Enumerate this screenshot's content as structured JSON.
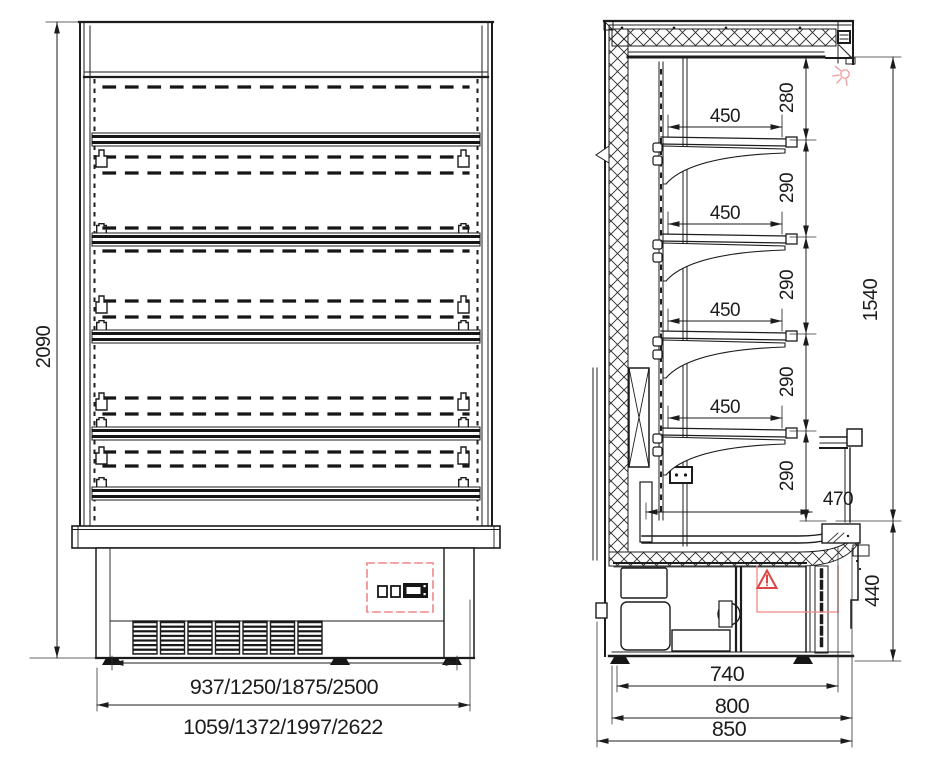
{
  "drawing": {
    "description": "Dimensioned technical drawing of a refrigerated multideck display cabinet: front elevation and side section",
    "front_view": {
      "dims": {
        "height": "2090",
        "inner_width": "937/1250/1875/2500",
        "overall_width": "1059/1372/1997/2622"
      }
    },
    "side_view": {
      "dims": {
        "top_clearance": "280",
        "shelf_pitch": [
          "290",
          "290",
          "290",
          "290"
        ],
        "shelf_depth": [
          "450",
          "450",
          "450",
          "450"
        ],
        "well_shelf_depth": "470",
        "opening_height": "1540",
        "base_height": "440",
        "base_depth": "740",
        "body_depth": "800",
        "overall_depth": "850"
      }
    },
    "icons": {
      "warning": "warning-triangle",
      "lamp": "light-indicator",
      "controller": "control-panel-display",
      "insulation": "cross-hatch",
      "grille": "ventilation-grille"
    },
    "colors": {
      "line": "#1c1c1c",
      "red_accent": "#dd4444",
      "soft_red": "#f08686",
      "pink": "#f2a2a2"
    }
  }
}
